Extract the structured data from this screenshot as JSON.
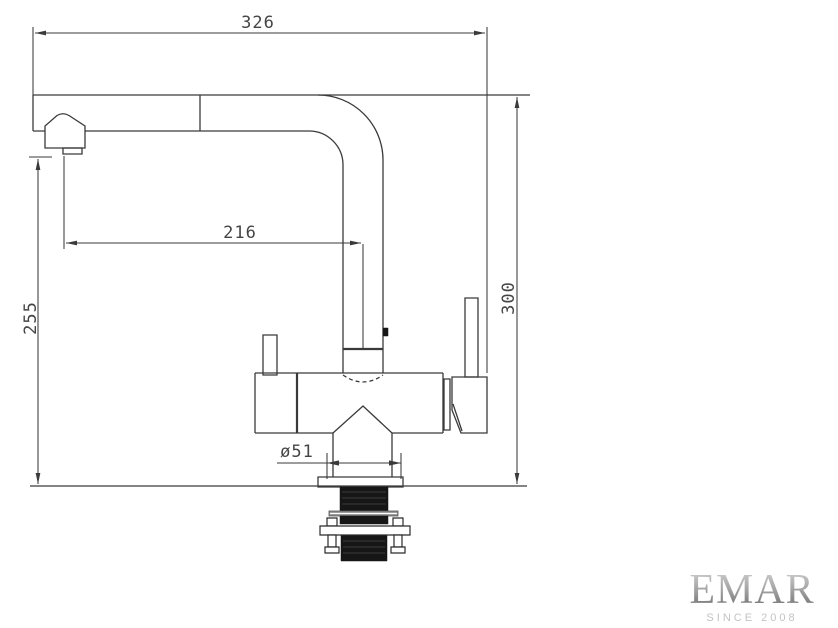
{
  "dimensions": {
    "overall_width": "326",
    "spout_reach": "216",
    "spout_height": "255",
    "overall_height": "300",
    "base_diameter": "ø51"
  },
  "logo": {
    "brand": "EMAR",
    "tagline": "SINCE 2008"
  },
  "colors": {
    "line": "#3a3a3a",
    "dimension_text": "#454545",
    "shank_fill": "#161616",
    "washer_gray": "#8f8f8f",
    "logo_brand": "#8f8f8f",
    "logo_tagline": "#c3c3c3",
    "background": "#ffffff"
  }
}
